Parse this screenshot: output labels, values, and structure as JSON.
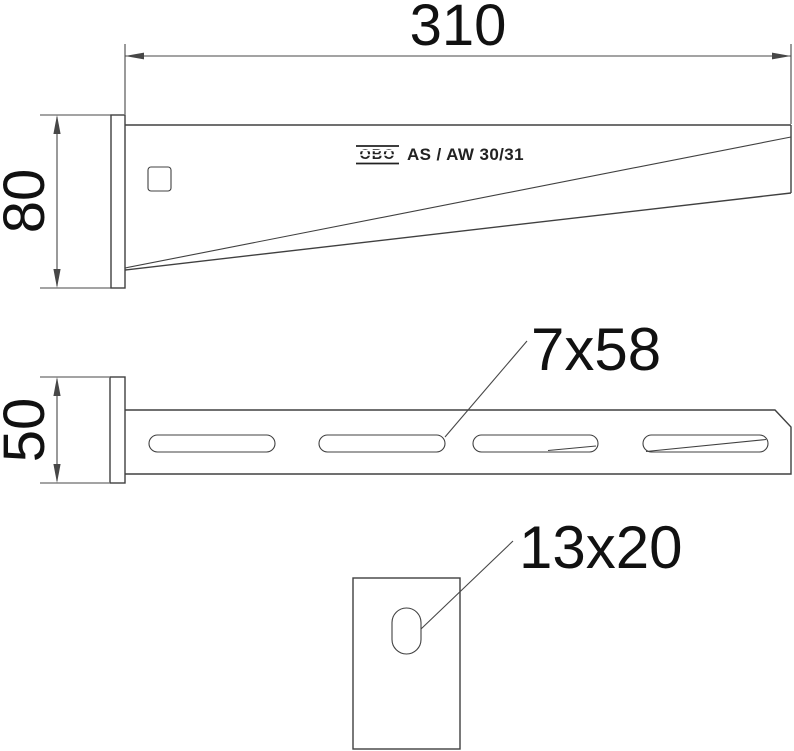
{
  "drawing": {
    "title_block": {
      "logo": "OBO",
      "model": "AS / AW 30/31"
    },
    "side_view": {
      "length_label": "310",
      "height_label": "80"
    },
    "plan_view": {
      "width_label": "50",
      "slot_label": "7x58"
    },
    "end_view": {
      "hole_label": "13x20"
    }
  },
  "colors": {
    "line": "#404040",
    "text": "#111111",
    "background": "#ffffff"
  }
}
